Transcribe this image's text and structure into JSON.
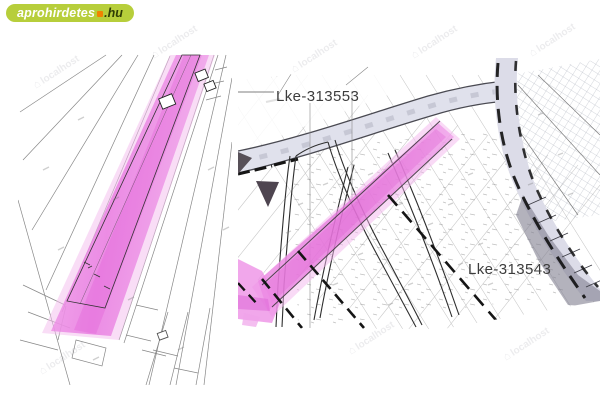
{
  "header": {
    "logo": {
      "main": "aprohirdetes",
      "tld": ".hu",
      "pill_color": "#b7ce3b",
      "dot_color": "#f08300",
      "text_color": "#ffffff",
      "tld_color": "#2f3d05"
    }
  },
  "left_map": {
    "highlight_color": "#e879e2"
  },
  "right_map": {
    "zone_labels": [
      {
        "text": "Lke-313553"
      },
      {
        "text": "Lke-313543"
      }
    ],
    "highlight_color": "#e879e2"
  },
  "watermark": {
    "icon": "⌂",
    "text": "localhost"
  }
}
